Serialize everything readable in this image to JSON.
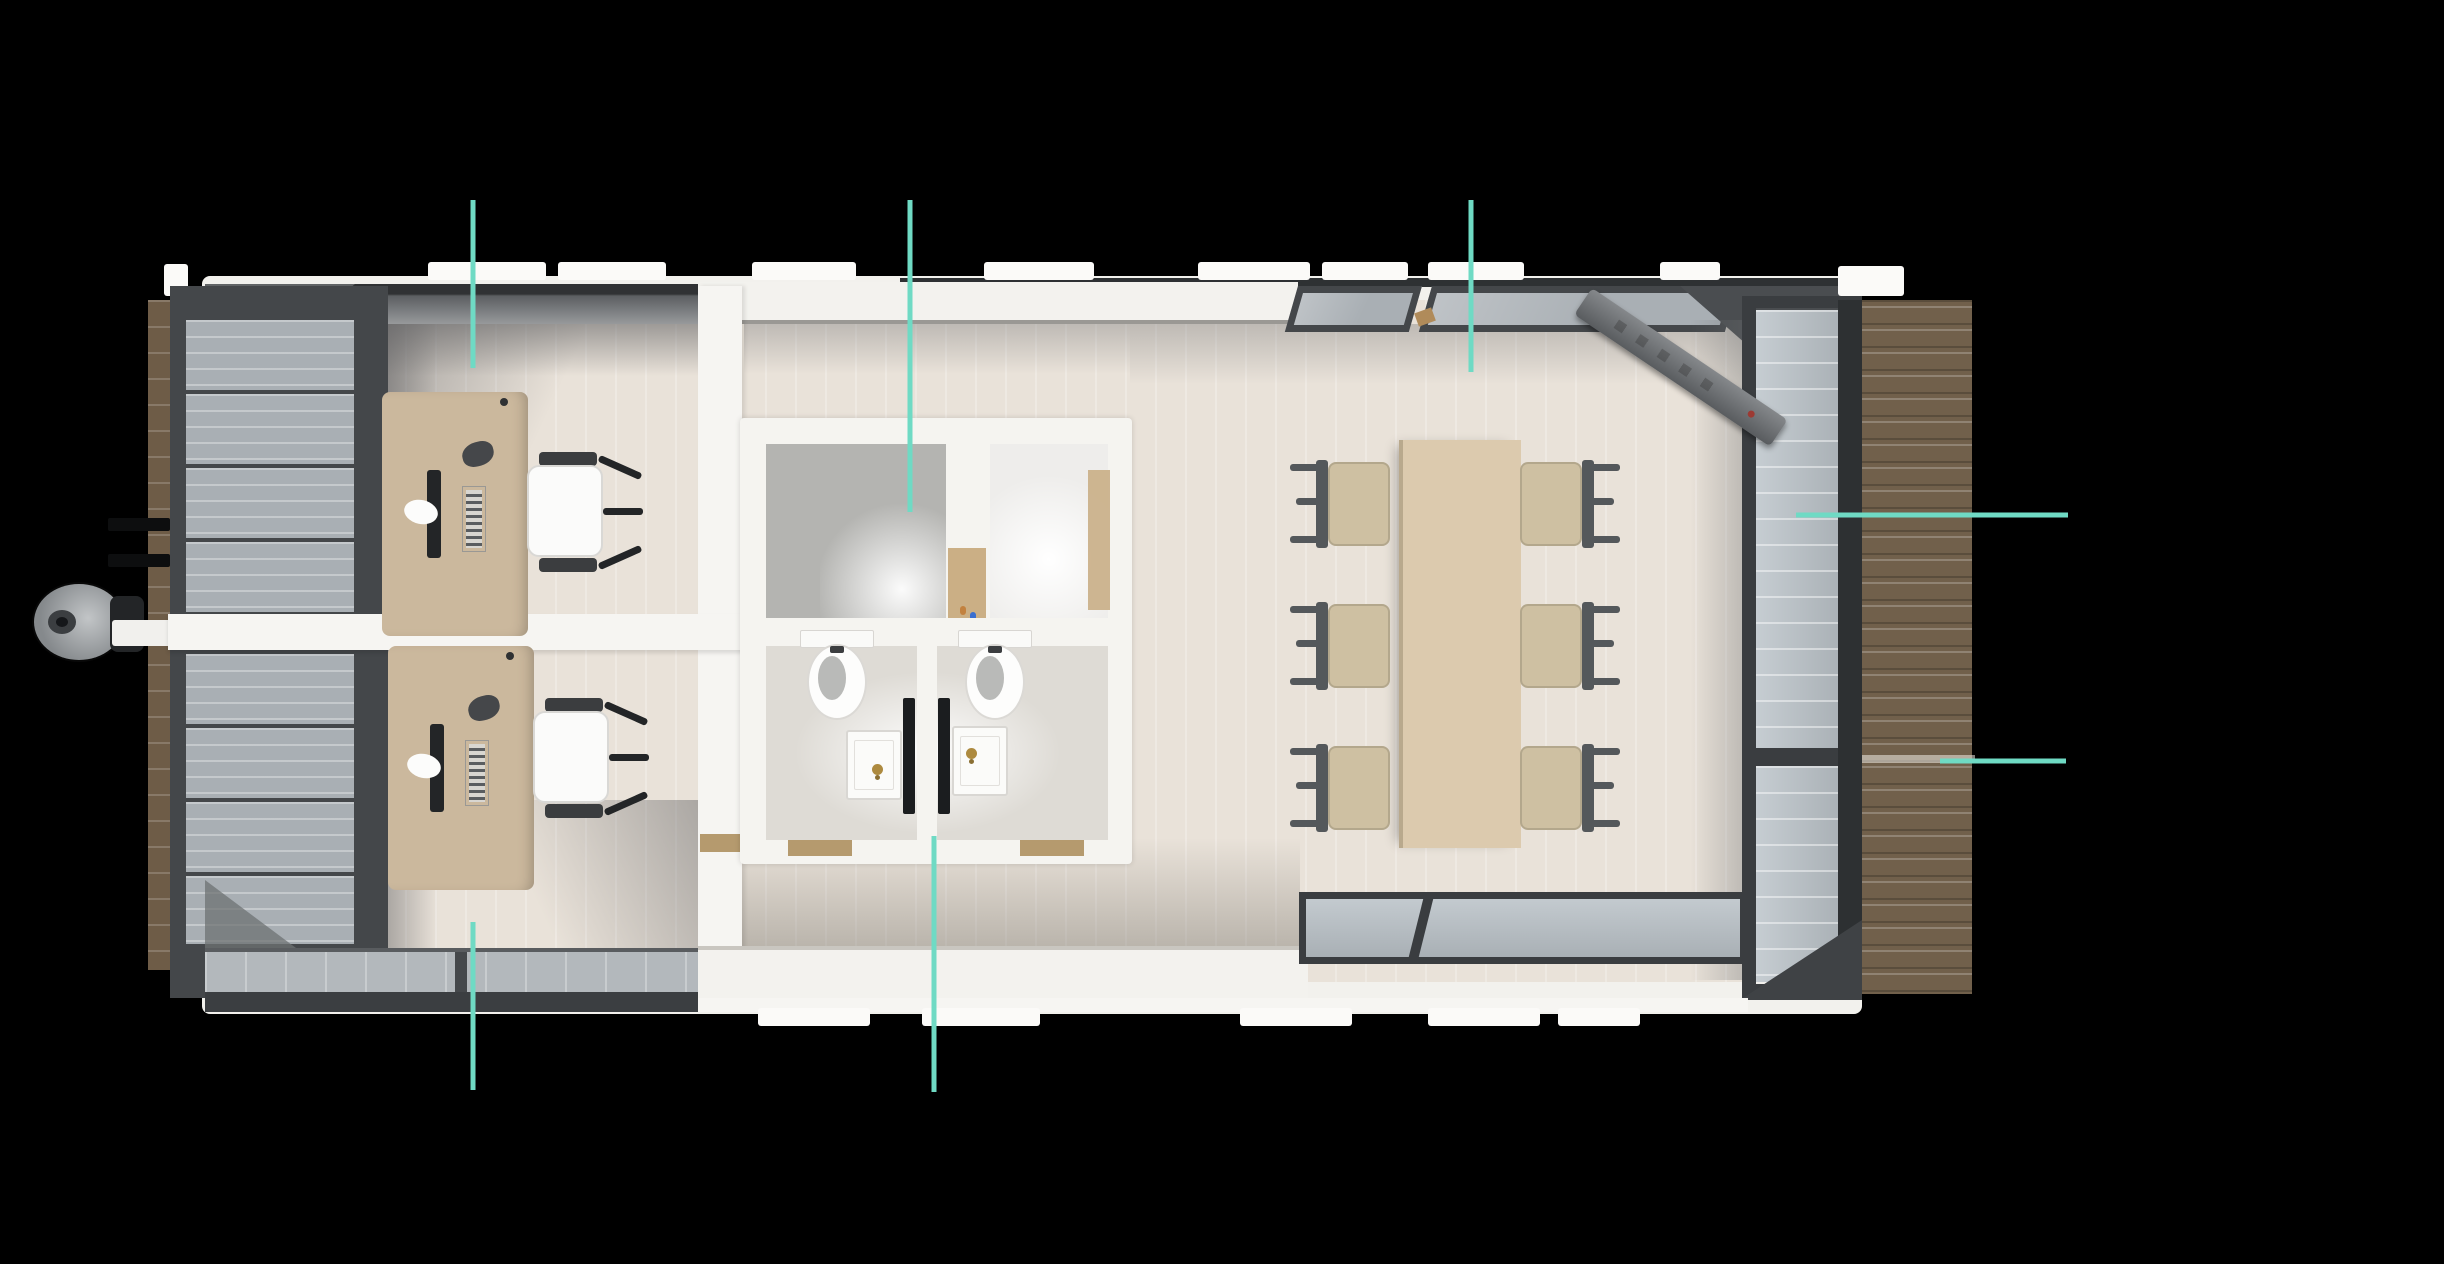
{
  "scene": {
    "type": "3d-top-down-floor-plan-render",
    "subject": "mobile office trailer with two offices, washroom, meeting room, side deck and tow hitch",
    "width": 2444,
    "height": 1264,
    "background": "#000000"
  },
  "palette": {
    "bg": "#000000",
    "floor": "#e9e2d9",
    "wall_white": "#f2f1ed",
    "frame_dark": "#44474a",
    "frame_darker": "#2d3032",
    "glass": "#a9afb4",
    "glass_light": "#c3cacf",
    "desk_tan": "#cbb89d",
    "table_tan": "#dccaae",
    "chair_seat": "#cec0a2",
    "chair_frame": "#54585b",
    "deck_brown": "#71604b",
    "deck_gap": "rgba(240,237,230,0.55)",
    "wood_edge": "#6e5c47",
    "door_tan": "#cbaf85",
    "threshold_tan": "#b59a6e",
    "faucet_gold": "#ad8a3f",
    "toilet_white": "#fdfdfc",
    "bowl_gray": "#b9bab8",
    "hitch_gray": "#85898c",
    "callout_teal": "#6fdac4"
  },
  "callouts": [
    {
      "id": "callout-1",
      "orientation": "vertical",
      "x1": 473,
      "y1": 200,
      "x2": 473,
      "y2": 368
    },
    {
      "id": "callout-2",
      "orientation": "vertical",
      "x1": 910,
      "y1": 200,
      "x2": 910,
      "y2": 512
    },
    {
      "id": "callout-3",
      "orientation": "vertical",
      "x1": 1471,
      "y1": 200,
      "x2": 1471,
      "y2": 372
    },
    {
      "id": "callout-4",
      "orientation": "horizontal",
      "x1": 1796,
      "y1": 515,
      "x2": 2068,
      "y2": 515
    },
    {
      "id": "callout-5",
      "orientation": "horizontal",
      "x1": 1940,
      "y1": 761,
      "x2": 2066,
      "y2": 761
    },
    {
      "id": "callout-6",
      "orientation": "vertical",
      "x1": 473,
      "y1": 922,
      "x2": 473,
      "y2": 1090
    },
    {
      "id": "callout-7",
      "orientation": "vertical",
      "x1": 934,
      "y1": 836,
      "x2": 934,
      "y2": 1092
    }
  ],
  "plan": {
    "rooms": [
      {
        "id": "office-top-left",
        "furniture": [
          "desk",
          "office-chair",
          "monitor",
          "keyboard",
          "phone"
        ]
      },
      {
        "id": "office-bottom-left",
        "furniture": [
          "desk",
          "office-chair",
          "monitor",
          "keyboard",
          "phone"
        ]
      },
      {
        "id": "washroom",
        "furniture": [
          "shower-room",
          "shower-room",
          "toilet",
          "toilet",
          "sink",
          "sink"
        ]
      },
      {
        "id": "meeting-room",
        "furniture": [
          "conference-table",
          "chair",
          "chair",
          "chair",
          "chair",
          "chair",
          "chair"
        ]
      },
      {
        "id": "deck"
      },
      {
        "id": "trailer-hitch"
      }
    ],
    "counts": {
      "desks": 2,
      "office_chairs": 2,
      "meeting_chairs": 6,
      "toilets": 2,
      "sinks": 2,
      "shower_rooms": 2,
      "callout_lines": 7
    }
  }
}
